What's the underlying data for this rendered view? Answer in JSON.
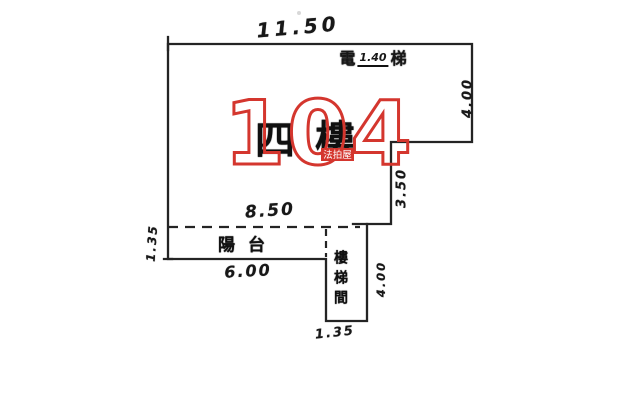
{
  "document": {
    "kind": "hand-drawn floor plan sketch"
  },
  "watermark": {
    "number": "104",
    "badge_text": "法拍屋",
    "red": "#d4362e"
  },
  "plan": {
    "line_color": "#242424",
    "floor_note": "四樓",
    "balcony_label": "陽台",
    "stair_shaft_label": "樓梯間",
    "top_note": {
      "left_char": "電",
      "value": "1.40",
      "right_char": "梯"
    },
    "dims": {
      "top_width": "11.50",
      "right_upper": "4.00",
      "right_mid": "3.50",
      "inner_width": "8.50",
      "balcony_width": "6.00",
      "balcony_depth_left": "1.35",
      "shaft_depth": "4.00",
      "shaft_width": "1.35"
    }
  }
}
